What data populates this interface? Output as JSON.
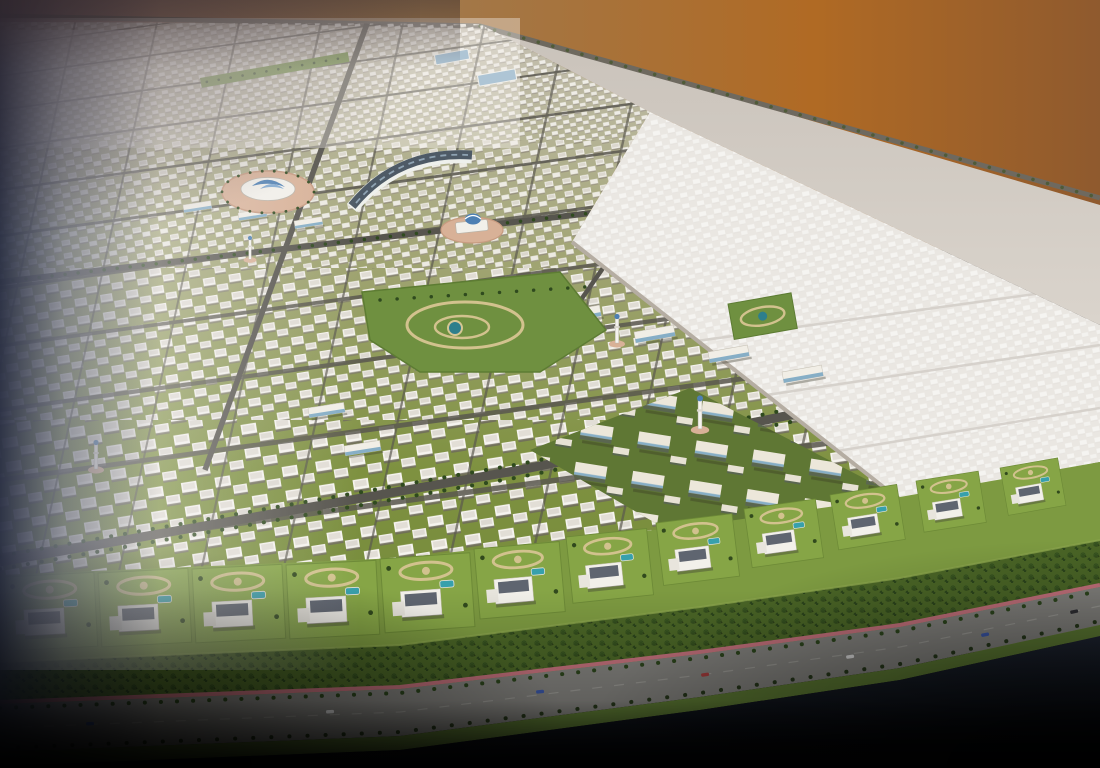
{
  "meta": {
    "type": "aerial-masterplan-rendering",
    "description": "Bird's-eye 3D rendering of a coastal desert residential masterplan at dusk: dense rows of white villas on green blocks, landmark dome pavilions, a curved community building, central parks with ponds, ghosted future-phase plots to the right, a beachfront row of large villas with pools, a palm grove, a pink cycle track and a coastal highway, with dark vignetted edges and an orange dusk sky in the upper right.",
    "visible_text_present": false
  },
  "colors": {
    "sky_mauve": "#8d7473",
    "sky_tan": "#a1794c",
    "sky_orange": "#b06a24",
    "sky_orange_deep": "#8f5a2e",
    "desert_shadow": "#c9c2ba",
    "desert_light": "#dad4cc",
    "built_sand": "#c7c1b4",
    "built_olive": "#a2a575",
    "built_green": "#7e9140",
    "built_green_deep": "#6f8638",
    "road_gray": "#5a584f",
    "arterial_gray": "#57554e",
    "ghost_fill": "#d9d3cb",
    "ghost_line": "#b0a89d",
    "plaza_pink": "#d8b197",
    "dome_blue": "#4d7fb3",
    "curved_roof_slate": "#4e5a66",
    "park_green": "#6f9040",
    "path_beige": "#d2c28e",
    "pond_teal": "#2e7f8c",
    "pool_teal": "#37a0ac",
    "lawn_green": "#86a546",
    "coast_green": "#7d9a41",
    "grove_green": "#4a6526",
    "palm_dark": "#2c451c",
    "track_pink": "#c4717c",
    "highway_gray": "#82817d",
    "median_green": "#5d7a33",
    "water_dark": "#27303f",
    "water_black": "#05070b",
    "villa_white": "#f2f0ea",
    "villa_roof": "#5f6570",
    "slab_cream": "#ece7da",
    "slab_stripe": "#86aec6",
    "vignette_navy": "#20263b"
  },
  "scene": {
    "regions": [
      "dusk-sky",
      "desert-plain",
      "built-villa-district",
      "ghost-future-phase",
      "slab-apartment-district",
      "central-park",
      "beachfront-villa-row",
      "palm-grove",
      "cycle-track",
      "coastal-highway",
      "median-strip",
      "sea-water"
    ],
    "landmarks": [
      "shell-dome-pavilion",
      "curved-community-building",
      "dome-pavilion",
      "mosque-minaret",
      "neighborhood-parks",
      "school-buildings"
    ],
    "counts": {
      "beachfront_villas": 12,
      "highway_cars": 7,
      "minarets": 4
    }
  }
}
